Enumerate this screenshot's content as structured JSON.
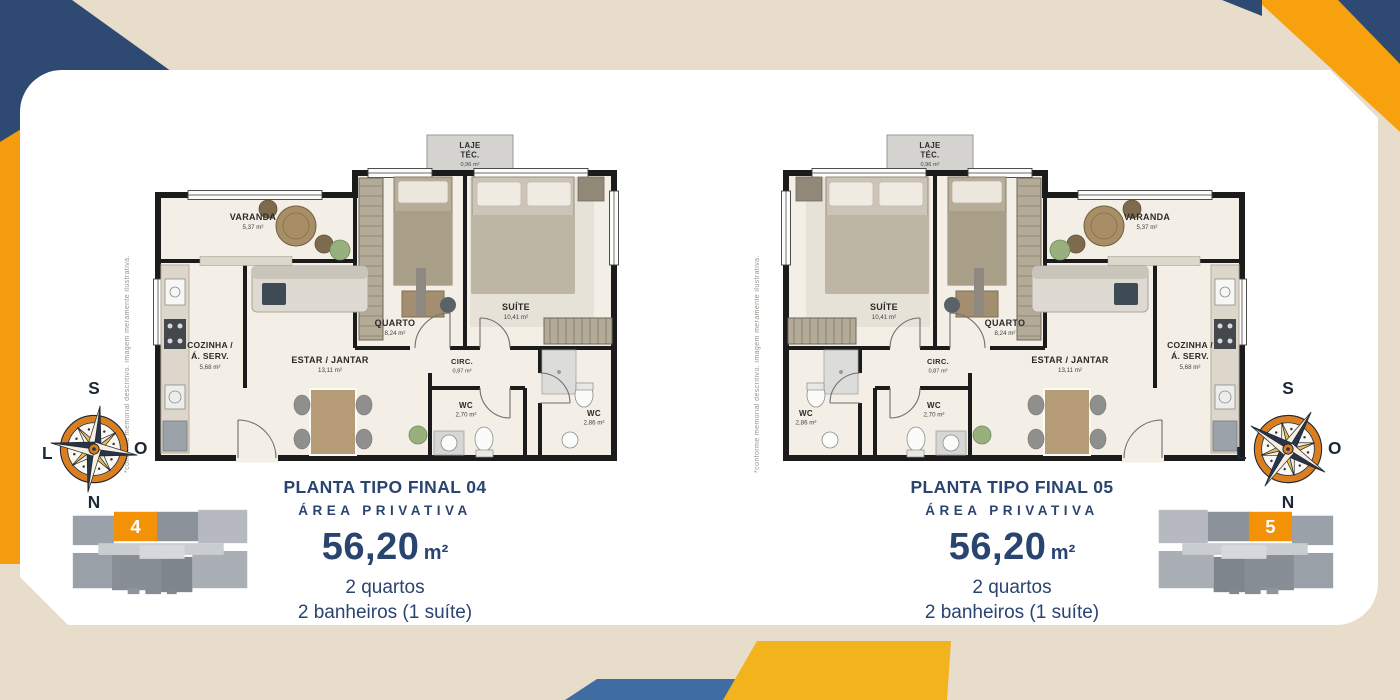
{
  "plans": [
    {
      "title": "PLANTA TIPO FINAL 04",
      "subtitle": "ÁREA PRIVATIVA",
      "area": "56,20",
      "area_unit": "m²",
      "bedrooms": "2 quartos",
      "bathrooms": "2 banheiros (1 suíte)",
      "unit_number": "4"
    },
    {
      "title": "PLANTA TIPO FINAL 05",
      "subtitle": "ÁREA PRIVATIVA",
      "area": "56,20",
      "area_unit": "m²",
      "bedrooms": "2 quartos",
      "bathrooms": "2 banheiros (1 suíte)",
      "unit_number": "5"
    }
  ],
  "rooms": {
    "laje": {
      "name": "LAJE",
      "name2": "TÉC.",
      "area": "0,96 m²"
    },
    "varanda": {
      "name": "VARANDA",
      "area": "5,37 m²"
    },
    "quarto": {
      "name": "QUARTO",
      "area": "8,24 m²"
    },
    "suite": {
      "name": "SUÍTE",
      "area": "10,41 m²"
    },
    "cozinha": {
      "name": "COZINHA /",
      "name2": "Á. SERV.",
      "area": "5,68 m²"
    },
    "estar": {
      "name": "ESTAR / JANTAR",
      "area": "13,11 m²"
    },
    "circ": {
      "name": "CIRC.",
      "area": "0,87 m²"
    },
    "wc1": {
      "name": "WC",
      "area": "2,70 m²"
    },
    "wc2": {
      "name": "WC",
      "area": "2,86 m²"
    }
  },
  "compass": {
    "top": "S",
    "right": "O",
    "bottom": "N",
    "left": "L"
  },
  "disclaimer": "*conforme memorial descritivo. imagem meramente ilustrativa.",
  "colors": {
    "navy": "#2e4a73",
    "text_navy": "#2a4470",
    "orange": "#f39207",
    "yellow": "#f2b31c",
    "blue": "#3e6ca3",
    "beige": "#e8dcca"
  }
}
